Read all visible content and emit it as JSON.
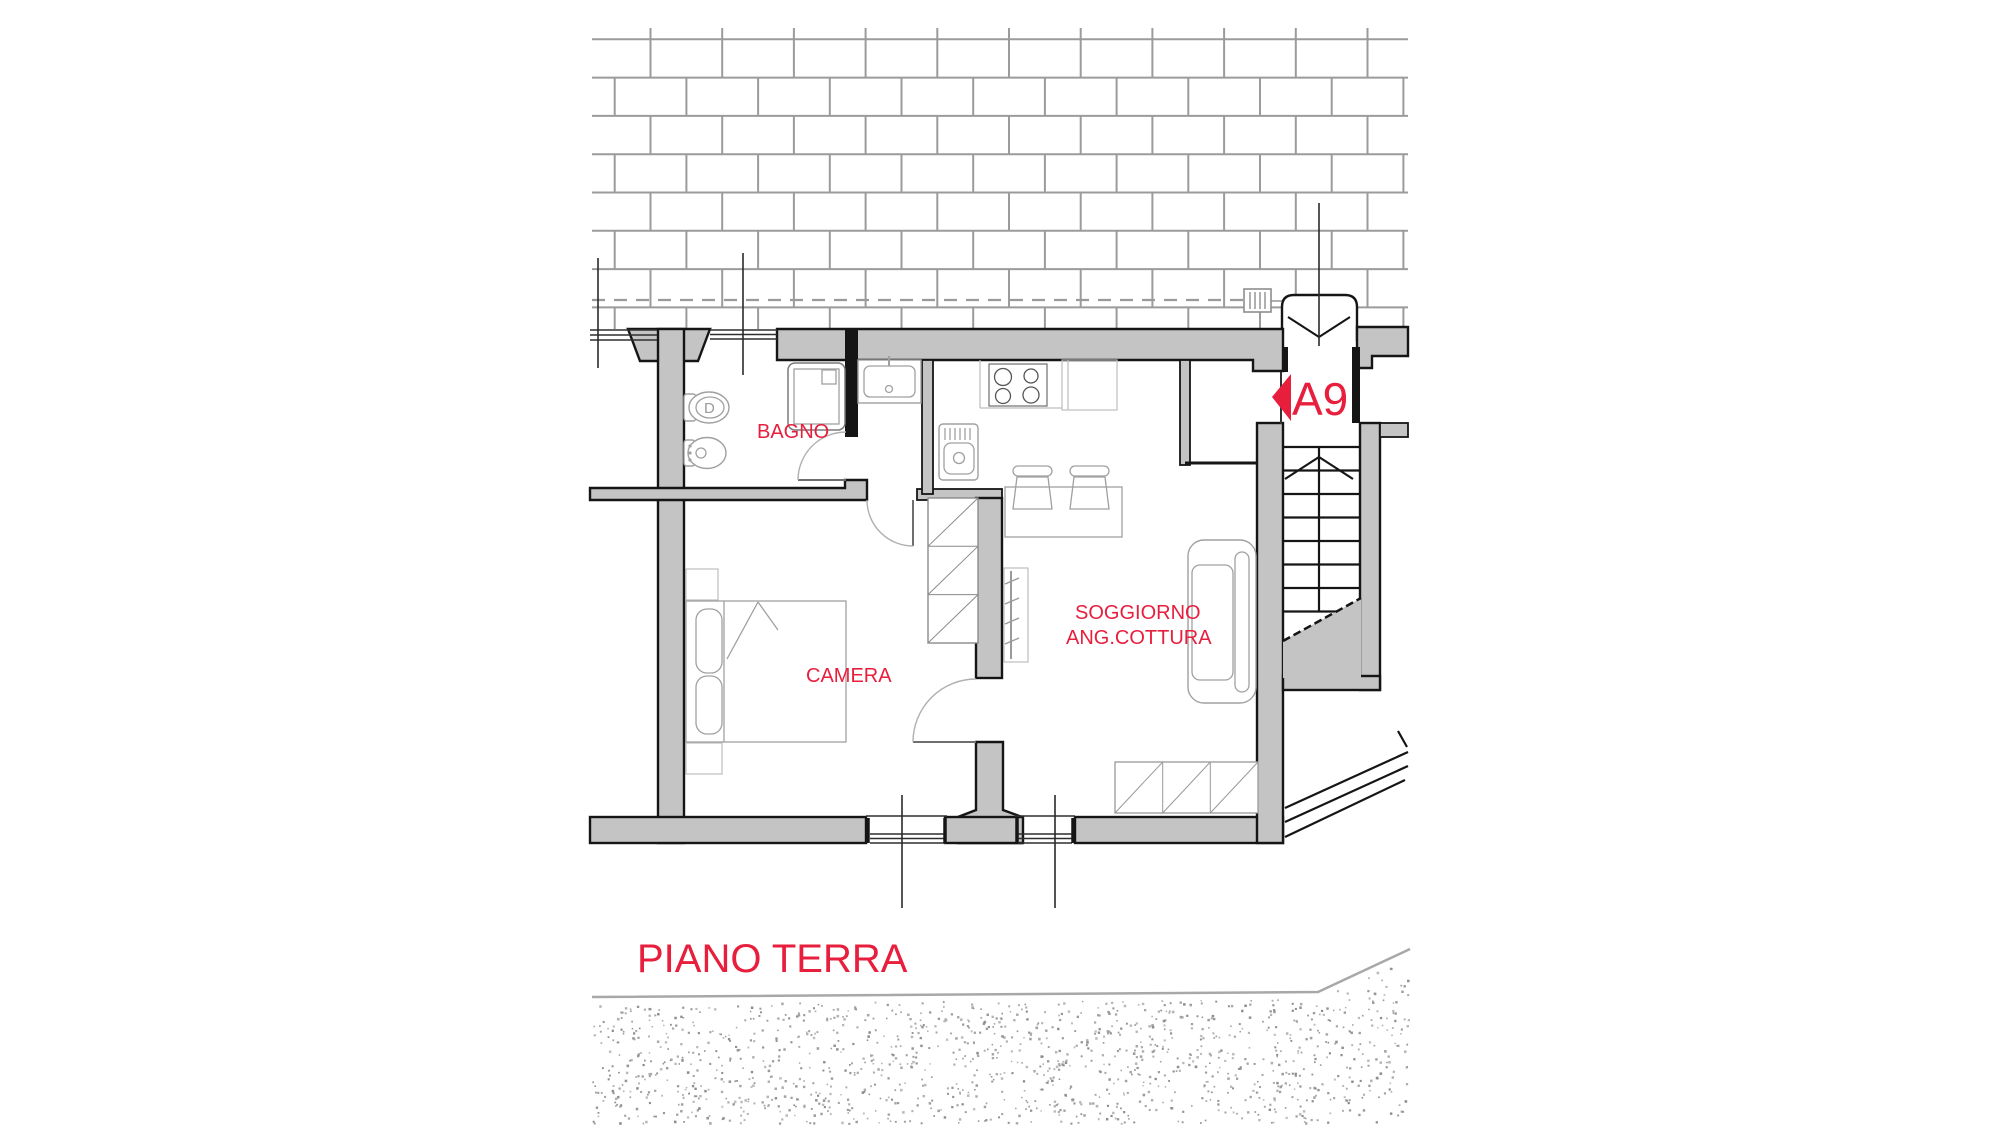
{
  "drawing": {
    "floor_title": "PIANO TERRA",
    "unit_label": "A9",
    "rooms": {
      "bathroom": "BAGNO",
      "bedroom": "CAMERA",
      "living_room_line1": "SOGGIORNO",
      "living_room_line2": "ANG.COTTURA"
    },
    "fixtures": {
      "wc_letter": "D"
    },
    "colors": {
      "label_red": "#e81e3d",
      "wall_fill": "#c4c4c4",
      "outline_black": "#151515",
      "brick_line": "#9b9b9b",
      "furniture_line": "#a0a0a0",
      "ground_line": "#a8a8a8"
    }
  }
}
